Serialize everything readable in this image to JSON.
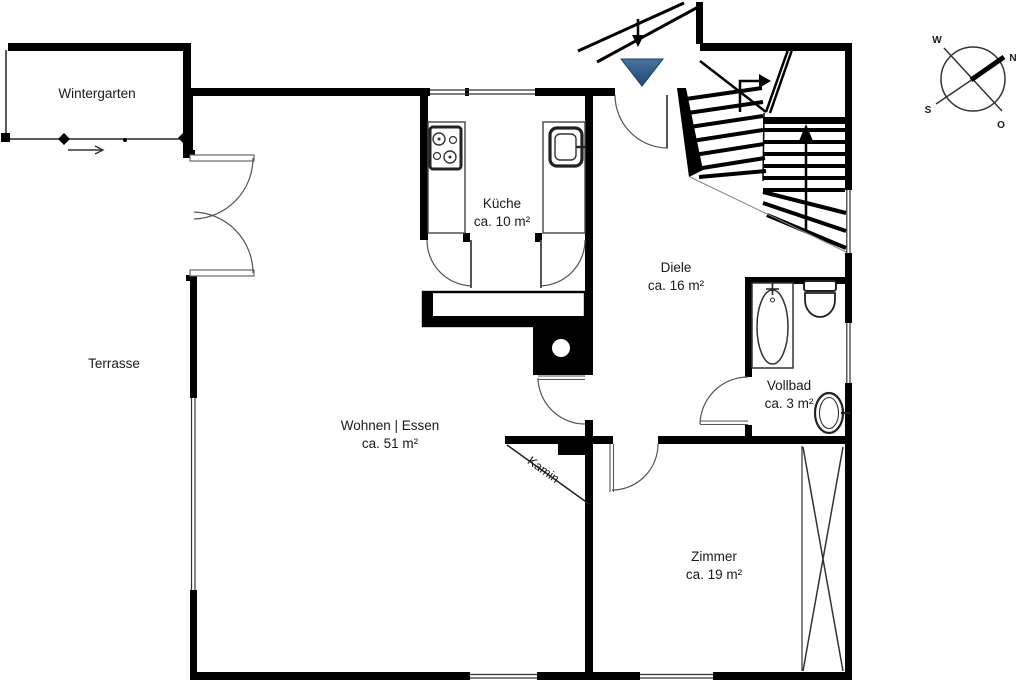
{
  "rooms": [
    {
      "id": "wintergarten",
      "label": "Wintergarten",
      "area": ""
    },
    {
      "id": "terrasse",
      "label": "Terrasse",
      "area": ""
    },
    {
      "id": "kueche",
      "label": "Küche",
      "area": "ca. 10 m²"
    },
    {
      "id": "diele",
      "label": "Diele",
      "area": "ca. 16 m²"
    },
    {
      "id": "wohnen-essen",
      "label": "Wohnen | Essen",
      "area": "ca. 51 m²"
    },
    {
      "id": "vollbad",
      "label": "Vollbad",
      "area": "ca. 3 m²"
    },
    {
      "id": "zimmer",
      "label": "Zimmer",
      "area": "ca. 19 m²"
    }
  ],
  "fireplace_label": "Kamin",
  "compass": {
    "west": "W",
    "north": "N",
    "south": "S",
    "east": "O"
  },
  "colors": {
    "wall": "#000000",
    "entry_marker_top": "#4a739f",
    "entry_marker_bottom": "#1d4a76"
  }
}
